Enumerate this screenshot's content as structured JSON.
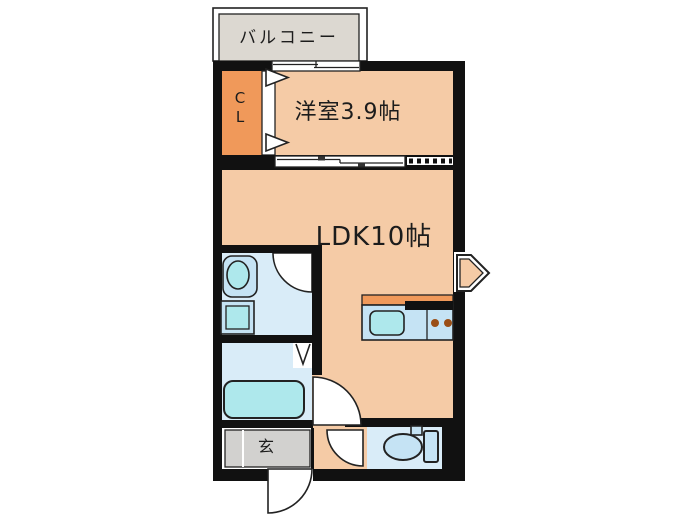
{
  "labels": {
    "balcony": "バルコニー",
    "closet_line1": "C",
    "closet_line2": "L",
    "western_room": "洋室3.9帖",
    "ldk": "LDK10帖",
    "entrance": "玄"
  },
  "colors": {
    "wall": "#111111",
    "room_peach": "#F5CBA6",
    "closet_orange": "#F0995A",
    "kitchen_orange": "#F0995A",
    "water_floor_blue": "#D9ECF8",
    "fixture_blue": "#C5E3F4",
    "basin_cyan": "#AEE8EC",
    "balcony_gray": "#DCD8D1",
    "entrance_gray": "#D2D1CF",
    "burner_brown": "#9A4E16",
    "outline": "#222222",
    "background": "#FFFFFF"
  }
}
